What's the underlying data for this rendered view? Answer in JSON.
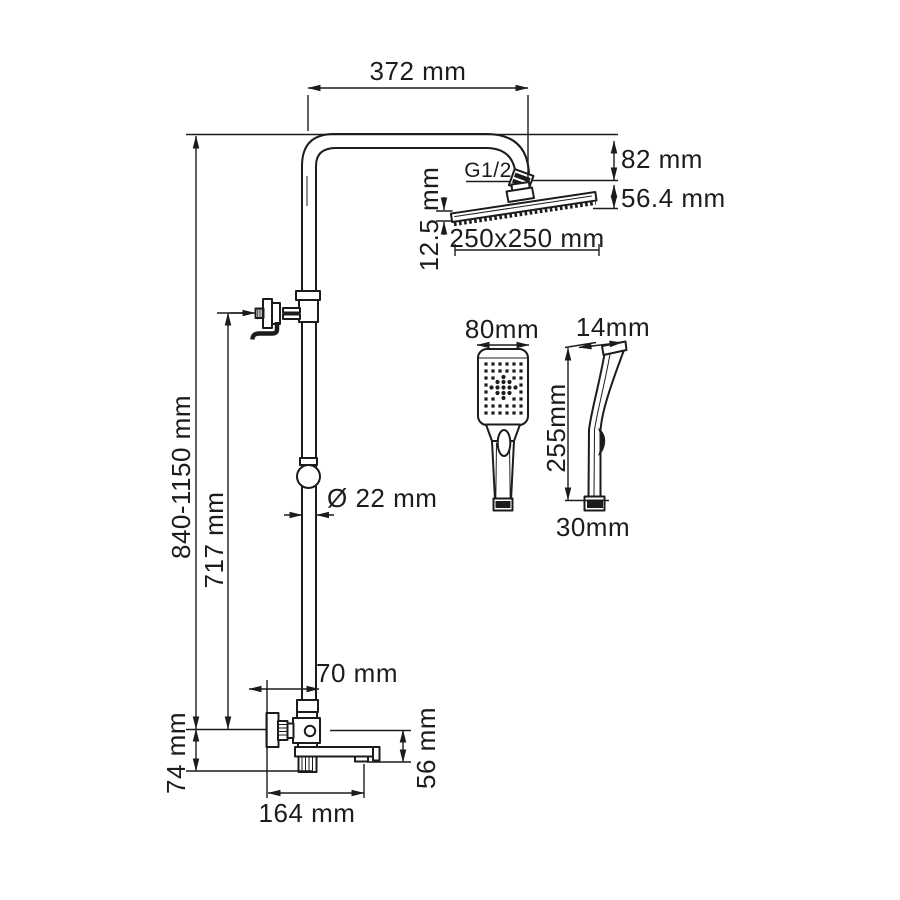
{
  "drawing": {
    "subject": "shower-system-technical-drawing",
    "views": {
      "main": "shower column with overhead shower and bath spout mixer",
      "handshower_front": "hand shower front view",
      "handshower_side": "hand shower side view"
    },
    "colors": {
      "line": "#1c1c1c",
      "background": "#ffffff"
    },
    "labels": {
      "arm_reach": "372 mm",
      "head_offset": "82 mm",
      "head_assembly_height": "56.4 mm",
      "head_thickness": "12.5 mm",
      "head_size": "250x250 mm",
      "thread": "G1/2",
      "column_height": "840-1150 mm",
      "bracket_height": "717 mm",
      "pipe_diameter": "Ø 22 mm",
      "handshower_width": "80mm",
      "handshower_top_depth": "14mm",
      "handshower_length": "255mm",
      "handshower_bottom_width": "30mm",
      "wall_to_pipe": "70 mm",
      "mixer_drop": "74 mm",
      "spout_drop": "56 mm",
      "spout_reach": "164 mm"
    }
  }
}
